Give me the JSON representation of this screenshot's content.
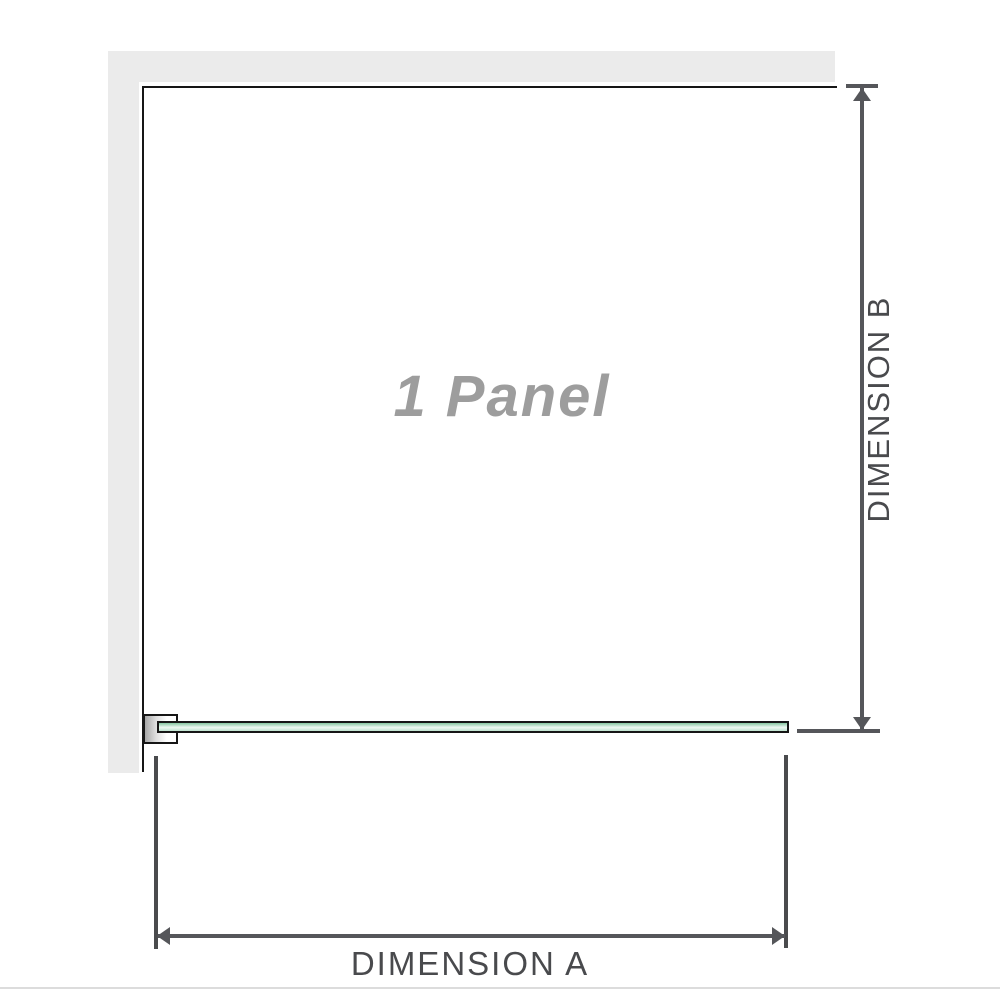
{
  "diagram": {
    "panel_label": "1 Panel",
    "dimension_a_label": "DIMENSION A",
    "dimension_b_label": "DIMENSION B",
    "colors": {
      "background": "#ffffff",
      "wall_fill": "#ebebeb",
      "outline": "#161616",
      "dimension_line": "#55565a",
      "extension_line": "#4a4b4d",
      "dimension_text": "#494a4d",
      "panel_label_text": "#9d9d9d",
      "glass_green_top": "#85c6a1",
      "glass_green_mid": "#eef8f2",
      "glass_green_bottom": "#bfe3cf",
      "bracket_shade": "#a6a6a6",
      "baseline": "#dcdcdc"
    }
  }
}
